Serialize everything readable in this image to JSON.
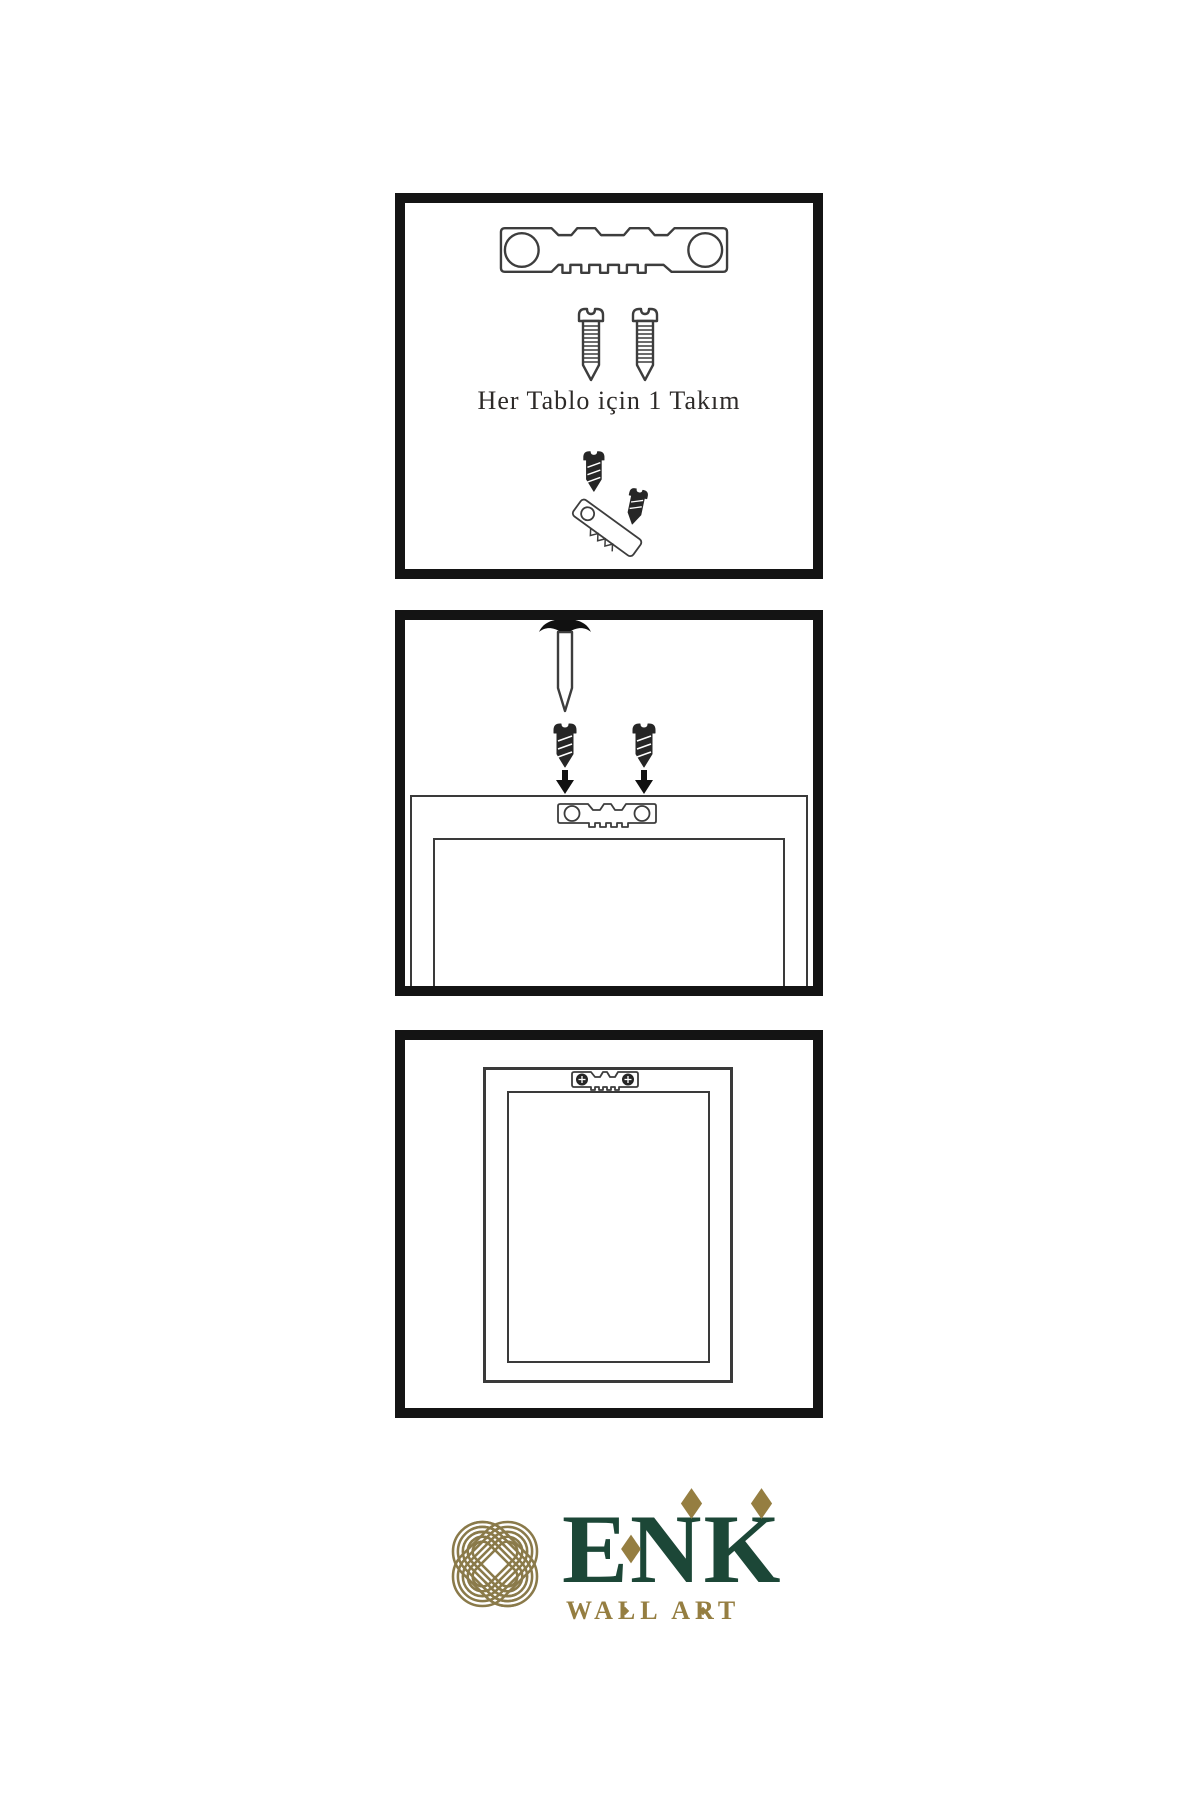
{
  "palette": {
    "panel_border": "#141414",
    "line_art": "#3d3d3d",
    "dark_metal": "#262626",
    "brand_green": "#1c4737",
    "brand_gold": "#957e41",
    "knot_gold": "#8a7a4a",
    "caption": "#2d2a28",
    "page_bg": "#ffffff"
  },
  "instructions": {
    "set_caption": "Her Tablo için 1 Takım"
  },
  "logo": {
    "wordmark": "ENK",
    "subtitle": "WALL ART"
  }
}
